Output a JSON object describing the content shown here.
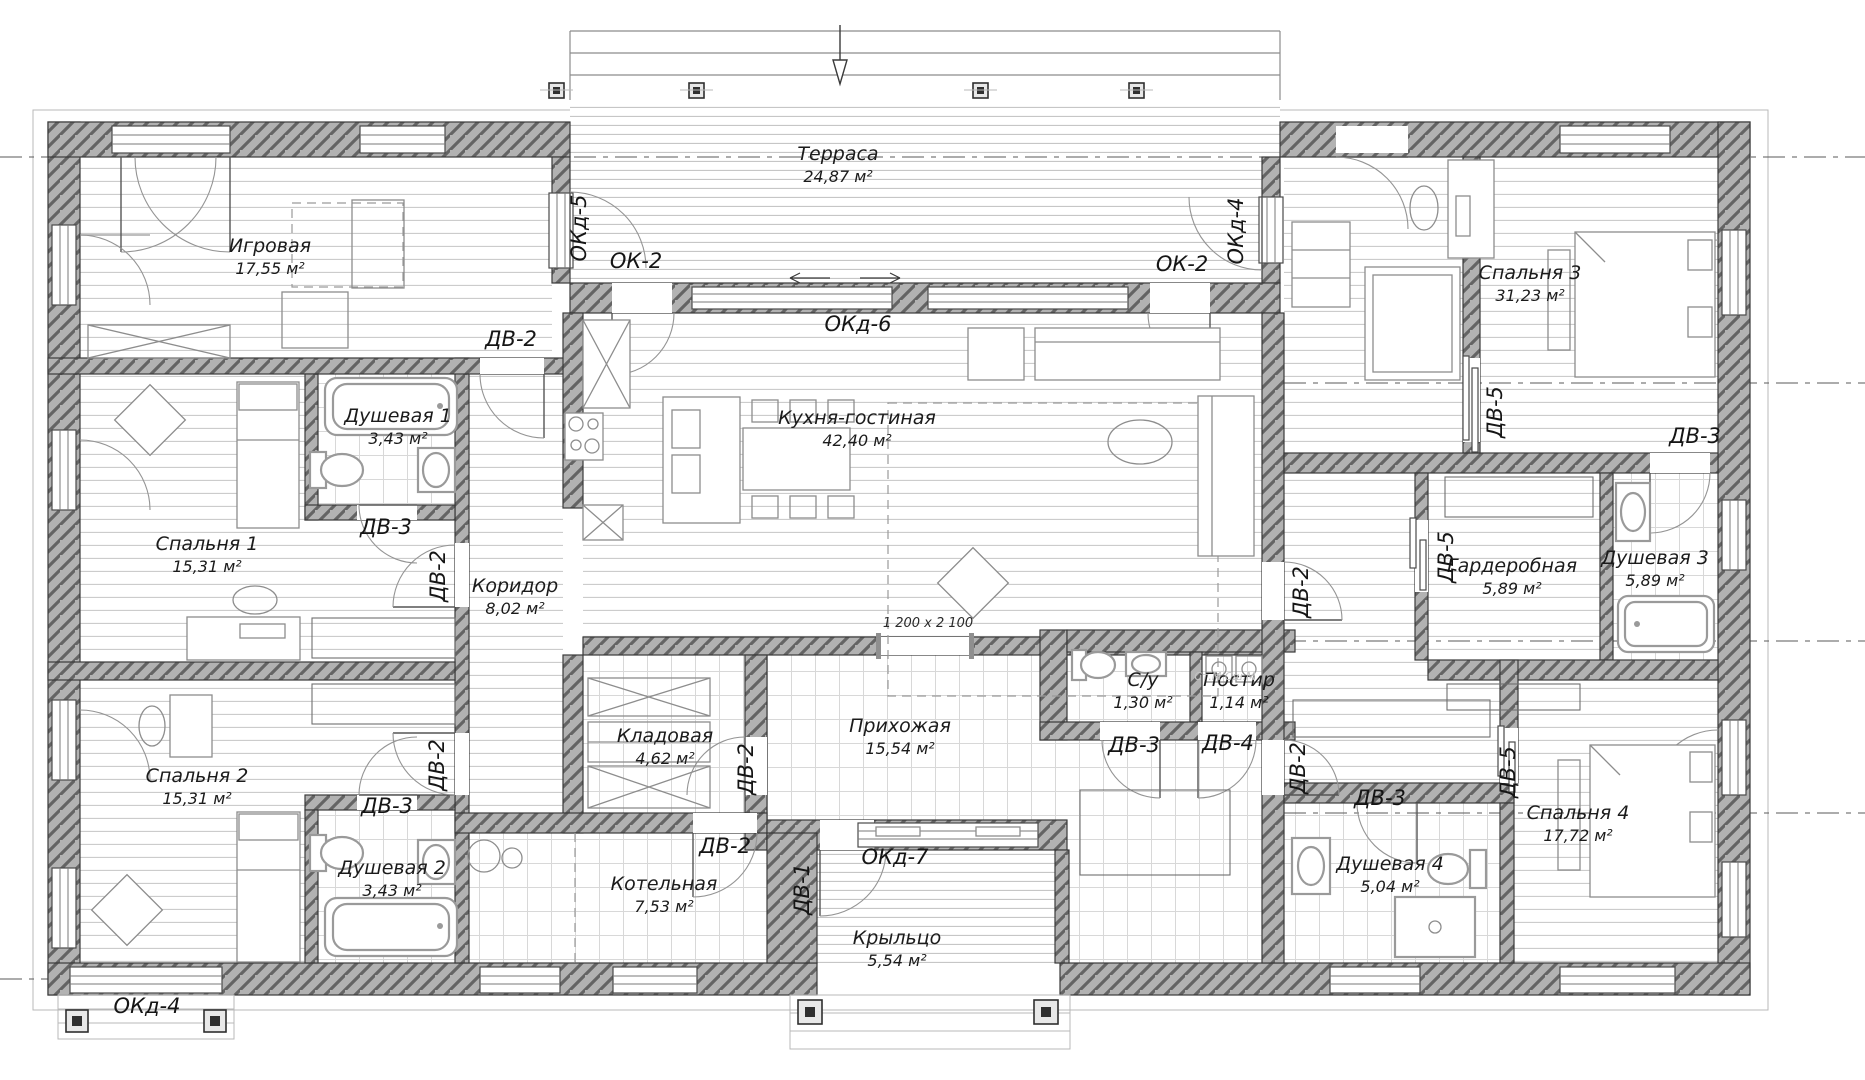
{
  "drawing": {
    "type": "architectural-floor-plan",
    "language": "ru",
    "units": "м²"
  },
  "rooms": [
    {
      "id": "terrasa",
      "name": "Терраса",
      "area": "24,87 м²",
      "x": 838,
      "y": 160
    },
    {
      "id": "igrovaya",
      "name": "Игровая",
      "area": "17,55 м²",
      "x": 270,
      "y": 252
    },
    {
      "id": "dushevaya-1",
      "name": "Душевая 1",
      "area": "3,43 м²",
      "x": 398,
      "y": 422
    },
    {
      "id": "spalnya-1",
      "name": "Спальня 1",
      "area": "15,31 м²",
      "x": 207,
      "y": 550
    },
    {
      "id": "spalnya-2",
      "name": "Спальня 2",
      "area": "15,31 м²",
      "x": 197,
      "y": 782
    },
    {
      "id": "dushevaya-2",
      "name": "Душевая 2",
      "area": "3,43 м²",
      "x": 392,
      "y": 874
    },
    {
      "id": "kuhnya",
      "name": "Кухня-гостиная",
      "area": "42,40 м²",
      "x": 857,
      "y": 424
    },
    {
      "id": "koridor",
      "name": "Коридор",
      "area": "8,02 м²",
      "x": 515,
      "y": 592
    },
    {
      "id": "kladovaya",
      "name": "Кладовая",
      "area": "4,62 м²",
      "x": 665,
      "y": 742
    },
    {
      "id": "prihozhaya",
      "name": "Прихожая",
      "area": "15,54 м²",
      "x": 900,
      "y": 732
    },
    {
      "id": "su",
      "name": "С/у",
      "area": "1,30 м²",
      "x": 1143,
      "y": 686
    },
    {
      "id": "postir",
      "name": "Постир",
      "area": "1,14 м²",
      "x": 1239,
      "y": 686
    },
    {
      "id": "kotelnaya",
      "name": "Котельная",
      "area": "7,53 м²",
      "x": 664,
      "y": 890
    },
    {
      "id": "kryltso",
      "name": "Крыльцо",
      "area": "5,54 м²",
      "x": 897,
      "y": 944
    },
    {
      "id": "spalnya-3",
      "name": "Спальня 3",
      "area": "31,23 м²",
      "x": 1530,
      "y": 279
    },
    {
      "id": "garderobnaya",
      "name": "Гардеробная",
      "area": "5,89 м²",
      "x": 1512,
      "y": 572
    },
    {
      "id": "dushevaya-3",
      "name": "Душевая 3",
      "area": "5,89 м²",
      "x": 1655,
      "y": 564
    },
    {
      "id": "spalnya-4",
      "name": "Спальня 4",
      "area": "17,72 м²",
      "x": 1578,
      "y": 819
    },
    {
      "id": "dushevaya-4",
      "name": "Душевая 4",
      "area": "5,04 м²",
      "x": 1390,
      "y": 870
    }
  ],
  "door_window_tags": [
    {
      "label": "ОКд-5",
      "x": 586,
      "y": 228,
      "rot": -90
    },
    {
      "label": "ОК-2",
      "x": 636,
      "y": 268,
      "rot": 0
    },
    {
      "label": "ОКд-6",
      "x": 858,
      "y": 331,
      "rot": 0
    },
    {
      "label": "ОК-2",
      "x": 1182,
      "y": 271,
      "rot": 0
    },
    {
      "label": "ОКд-4",
      "x": 1243,
      "y": 231,
      "rot": -90
    },
    {
      "label": "ДВ-2",
      "x": 511,
      "y": 346,
      "rot": 0
    },
    {
      "label": "ДВ-3",
      "x": 386,
      "y": 534,
      "rot": 0
    },
    {
      "label": "ДВ-2",
      "x": 445,
      "y": 576,
      "rot": -90
    },
    {
      "label": "ДВ-2",
      "x": 444,
      "y": 765,
      "rot": -90
    },
    {
      "label": "ДВ-3",
      "x": 387,
      "y": 813,
      "rot": 0
    },
    {
      "label": "ДВ-2",
      "x": 753,
      "y": 769,
      "rot": -90
    },
    {
      "label": "ДВ-2",
      "x": 725,
      "y": 853,
      "rot": 0
    },
    {
      "label": "ДВ-1",
      "x": 809,
      "y": 889,
      "rot": -90
    },
    {
      "label": "ОКд-7",
      "x": 895,
      "y": 864,
      "rot": 0
    },
    {
      "label": "ОКд-4",
      "x": 147,
      "y": 1013,
      "rot": 0
    },
    {
      "label": "ДВ-3",
      "x": 1134,
      "y": 752,
      "rot": 0
    },
    {
      "label": "ДВ-4",
      "x": 1228,
      "y": 750,
      "rot": 0
    },
    {
      "label": "ДВ-2",
      "x": 1305,
      "y": 768,
      "rot": -90
    },
    {
      "label": "ДВ-3",
      "x": 1380,
      "y": 805,
      "rot": 0
    },
    {
      "label": "ДВ-5",
      "x": 1515,
      "y": 772,
      "rot": -90
    },
    {
      "label": "ДВ-2",
      "x": 1308,
      "y": 592,
      "rot": -90
    },
    {
      "label": "ДВ-5",
      "x": 1502,
      "y": 412,
      "rot": -90
    },
    {
      "label": "ДВ-5",
      "x": 1453,
      "y": 557,
      "rot": -90
    },
    {
      "label": "ДВ-3",
      "x": 1695,
      "y": 443,
      "rot": 0
    }
  ],
  "notes": [
    {
      "text": "1 200 x 2 100",
      "x": 928,
      "y": 627,
      "style": "dim"
    },
    {
      "text": "Ст.М   Сш.М",
      "x": 1225,
      "y": 680,
      "style": "faint"
    }
  ],
  "colors": {
    "wall_fill": "#b2b2b2",
    "wall_hatch": "#646464",
    "outline": "#3a3a3a",
    "floor_line": "#cccccc",
    "tile_line": "#d8d8d8",
    "door_arc": "#949494",
    "text": "#1b1b1b",
    "axis": "#5a5a5a",
    "faint_text": "#c4c4c4"
  }
}
